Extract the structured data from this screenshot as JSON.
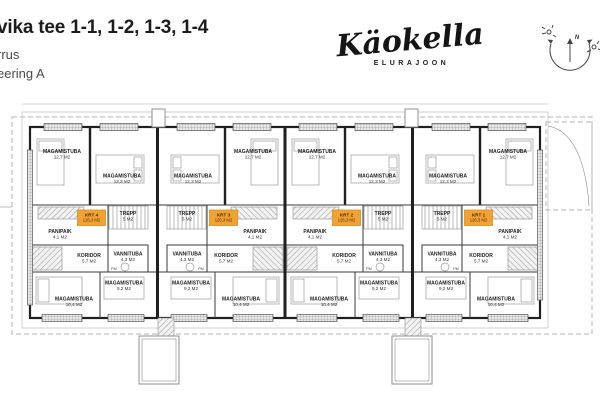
{
  "header": {
    "title": "vika tee 1-1, 1-2, 1-3, 1-4",
    "subtitle_line1": "rrus",
    "subtitle_line2": "eering A"
  },
  "logo": {
    "name": "Käokella",
    "tagline": "ELURAJOON"
  },
  "compass": {
    "north": "N"
  },
  "plan": {
    "accent_color": "#F2A235",
    "wall_color": "#1f1f1f",
    "pm_label": "PM",
    "units": [
      {
        "label": "KRT 4",
        "area": "126,3 M2",
        "mirrored": false,
        "rooms": [
          {
            "name": "MAGAMISTUBA",
            "area": "12,7 M2"
          },
          {
            "name": "MAGAMISTUBA",
            "area": "12,3 M2"
          },
          {
            "name": "PANIPAIK",
            "area": "4,1 M2"
          },
          {
            "name": "TREPP",
            "area": "5 M2"
          },
          {
            "name": "KORIDOR",
            "area": "5,7 M2"
          },
          {
            "name": "VANNITUBA",
            "area": "4,3 M2"
          },
          {
            "name": "MAGAMISTUBA",
            "area": "9,2 M2"
          },
          {
            "name": "MAGAMISTUBA",
            "area": "10,4 M2"
          }
        ]
      },
      {
        "label": "KRT 3",
        "area": "126,3 M2",
        "mirrored": true,
        "rooms": [
          {
            "name": "MAGAMISTUBA",
            "area": "12,7 M2"
          },
          {
            "name": "MAGAMISTUBA",
            "area": "12,3 M2"
          },
          {
            "name": "PANIPAIK",
            "area": "4,1 M2"
          },
          {
            "name": "TREPP",
            "area": "5 M2"
          },
          {
            "name": "KORIDOR",
            "area": "5,7 M2"
          },
          {
            "name": "VANNITUBA",
            "area": "4,3 M2"
          },
          {
            "name": "MAGAMISTUBA",
            "area": "9,2 M2"
          },
          {
            "name": "MAGAMISTUBA",
            "area": "10,4 M2"
          }
        ]
      },
      {
        "label": "KRT 2",
        "area": "126,3 M2",
        "mirrored": false,
        "rooms": [
          {
            "name": "MAGAMISTUBA",
            "area": "12,7 M2"
          },
          {
            "name": "MAGAMISTUBA",
            "area": "12,3 M2"
          },
          {
            "name": "PANIPAIK",
            "area": "4,1 M2"
          },
          {
            "name": "TREPP",
            "area": "5 M2"
          },
          {
            "name": "KORIDOR",
            "area": "5,7 M2"
          },
          {
            "name": "VANNITUBA",
            "area": "4,3 M2"
          },
          {
            "name": "MAGAMISTUBA",
            "area": "9,2 M2"
          },
          {
            "name": "MAGAMISTUBA",
            "area": "10,4 M2"
          }
        ]
      },
      {
        "label": "KRT 1",
        "area": "126,3 M2",
        "mirrored": true,
        "rooms": [
          {
            "name": "MAGAMISTUBA",
            "area": "12,7 M2"
          },
          {
            "name": "MAGAMISTUBA",
            "area": "12,3 M2"
          },
          {
            "name": "PANIPAIK",
            "area": "4,1 M2"
          },
          {
            "name": "TREPP",
            "area": "5 M2"
          },
          {
            "name": "KORIDOR",
            "area": "5,7 M2"
          },
          {
            "name": "VANNITUBA",
            "area": "4,3 M2"
          },
          {
            "name": "MAGAMISTUBA",
            "area": "9,2 M2"
          },
          {
            "name": "MAGAMISTUBA",
            "area": "10,4 M2"
          }
        ]
      }
    ]
  }
}
